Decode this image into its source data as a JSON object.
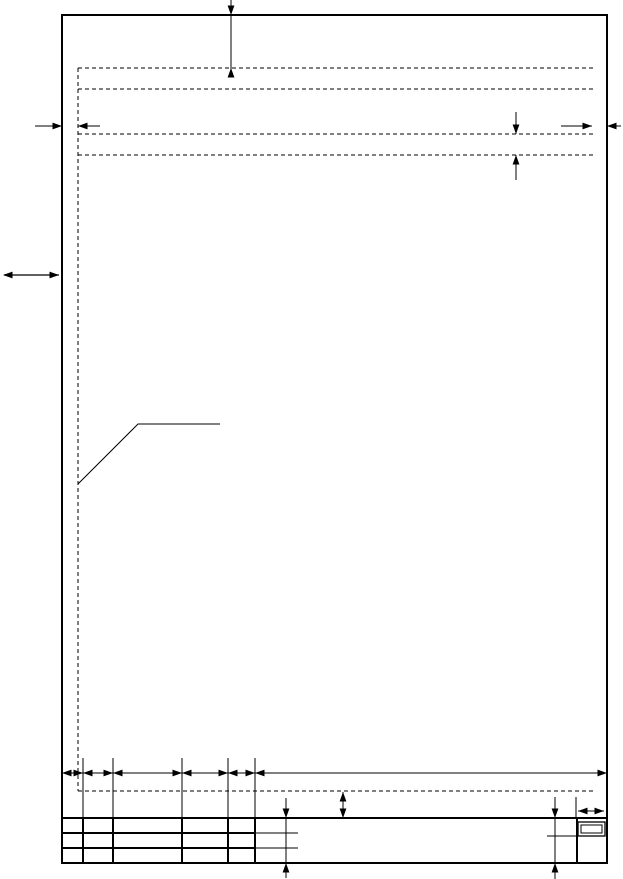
{
  "figure": {
    "description": "drawing-sheet-template-with-margin-and-title-block-dimensions",
    "background": "#ffffff",
    "ink": "#000000"
  },
  "drawing": {
    "width": 623,
    "height": 879,
    "dash_pattern": "4 3",
    "arrow": {
      "length": 9.5,
      "half_width": 3.4
    },
    "groups": [
      {
        "name": "sheet-frame",
        "rects": [
          {
            "name": "sheet-border",
            "x": 62,
            "y": 15,
            "w": 545,
            "h": 848,
            "sw": 2
          }
        ]
      },
      {
        "name": "text-margin-guides",
        "lines": [
          {
            "name": "left-margin-guide",
            "x1": 78,
            "y1": 68,
            "x2": 78,
            "y2": 791,
            "sw": 1,
            "dash": true
          },
          {
            "name": "top-margin-guide",
            "x1": 78,
            "y1": 68,
            "x2": 593,
            "y2": 68,
            "sw": 1,
            "dash": true
          },
          {
            "name": "header-guide-1",
            "x1": 78,
            "y1": 89,
            "x2": 593,
            "y2": 89,
            "sw": 1,
            "dash": true
          },
          {
            "name": "header-guide-2",
            "x1": 78,
            "y1": 134,
            "x2": 593,
            "y2": 134,
            "sw": 1,
            "dash": true
          },
          {
            "name": "header-guide-3",
            "x1": 78,
            "y1": 155,
            "x2": 593,
            "y2": 155,
            "sw": 1,
            "dash": true
          },
          {
            "name": "bottom-margin-guide",
            "x1": 78,
            "y1": 791,
            "x2": 593,
            "y2": 791,
            "sw": 1,
            "dash": true
          }
        ]
      },
      {
        "name": "leader-line",
        "polylines": [
          {
            "name": "margin-callout-leader",
            "sw": 1,
            "points": [
              [
                78,
                484
              ],
              [
                138,
                424
              ],
              [
                220,
                424
              ]
            ]
          }
        ]
      },
      {
        "name": "title-block",
        "lines": [
          {
            "name": "title-block-top",
            "x1": 62,
            "y1": 818,
            "x2": 607,
            "y2": 818,
            "sw": 2
          },
          {
            "name": "title-block-row-1",
            "x1": 62,
            "y1": 833,
            "x2": 255,
            "y2": 833,
            "sw": 2
          },
          {
            "name": "title-block-row-2",
            "x1": 62,
            "y1": 848,
            "x2": 255,
            "y2": 848,
            "sw": 2
          },
          {
            "name": "title-block-col-1",
            "x1": 83,
            "y1": 818,
            "x2": 83,
            "y2": 863,
            "sw": 2
          },
          {
            "name": "title-block-col-2",
            "x1": 113,
            "y1": 818,
            "x2": 113,
            "y2": 863,
            "sw": 2
          },
          {
            "name": "title-block-col-3",
            "x1": 182,
            "y1": 818,
            "x2": 182,
            "y2": 863,
            "sw": 2
          },
          {
            "name": "title-block-col-4",
            "x1": 228,
            "y1": 818,
            "x2": 228,
            "y2": 863,
            "sw": 2
          },
          {
            "name": "title-block-col-5",
            "x1": 255,
            "y1": 818,
            "x2": 255,
            "y2": 863,
            "sw": 2
          },
          {
            "name": "title-block-col-6",
            "x1": 577,
            "y1": 818,
            "x2": 577,
            "y2": 863,
            "sw": 2
          },
          {
            "name": "row-1-stub",
            "x1": 255,
            "y1": 833,
            "x2": 298,
            "y2": 833,
            "sw": 1
          },
          {
            "name": "row-2-stub",
            "x1": 255,
            "y1": 848,
            "x2": 298,
            "y2": 848,
            "sw": 1
          },
          {
            "name": "sheet-cell-divider",
            "x1": 547,
            "y1": 836,
            "x2": 578,
            "y2": 836,
            "sw": 1
          }
        ],
        "rects": [
          {
            "name": "sheet-number-box-outer",
            "x": 578,
            "y": 822,
            "w": 27,
            "h": 14,
            "sw": 1.3
          },
          {
            "name": "sheet-number-box-inner",
            "x": 581,
            "y": 825,
            "w": 21,
            "h": 8,
            "sw": 1
          }
        ]
      },
      {
        "name": "top-margin-dimension",
        "lines": [
          {
            "name": "dim-line",
            "x1": 231,
            "y1": 0,
            "x2": 231,
            "y2": 77,
            "sw": 1
          }
        ],
        "arrows": [
          {
            "name": "arrowhead-down",
            "x": 231,
            "y": 15,
            "dir": "down"
          },
          {
            "name": "arrowhead-up",
            "x": 231,
            "y": 68,
            "dir": "up"
          }
        ]
      },
      {
        "name": "left-margin-dimension",
        "lines": [
          {
            "name": "dim-tail-left",
            "x1": 35,
            "y1": 126,
            "x2": 62,
            "y2": 126,
            "sw": 1
          },
          {
            "name": "dim-tail-right",
            "x1": 78,
            "y1": 126,
            "x2": 100,
            "y2": 126,
            "sw": 1
          }
        ],
        "arrows": [
          {
            "name": "arrowhead-right",
            "x": 62,
            "y": 126,
            "dir": "right"
          },
          {
            "name": "arrowhead-left",
            "x": 78,
            "y": 126,
            "dir": "left"
          }
        ]
      },
      {
        "name": "right-margin-dimension",
        "lines": [
          {
            "name": "dim-tail-left",
            "x1": 561,
            "y1": 126,
            "x2": 592,
            "y2": 126,
            "sw": 1
          },
          {
            "name": "dim-tail-right",
            "x1": 607,
            "y1": 126,
            "x2": 621,
            "y2": 126,
            "sw": 1
          }
        ],
        "arrows": [
          {
            "name": "arrowhead-right",
            "x": 592,
            "y": 126,
            "dir": "right"
          },
          {
            "name": "arrowhead-left",
            "x": 607,
            "y": 126,
            "dir": "left"
          }
        ]
      },
      {
        "name": "header-spacing-dimension",
        "lines": [
          {
            "name": "dim-tail-top",
            "x1": 516,
            "y1": 112,
            "x2": 516,
            "y2": 134,
            "sw": 1
          },
          {
            "name": "dim-tail-bottom",
            "x1": 516,
            "y1": 155,
            "x2": 516,
            "y2": 180,
            "sw": 1
          }
        ],
        "arrows": [
          {
            "name": "arrowhead-down",
            "x": 516,
            "y": 134,
            "dir": "down"
          },
          {
            "name": "arrowhead-up",
            "x": 516,
            "y": 155,
            "dir": "up"
          }
        ]
      },
      {
        "name": "binding-margin-arrow",
        "lines": [
          {
            "name": "dim-line",
            "x1": 4,
            "y1": 275,
            "x2": 59,
            "y2": 275,
            "sw": 1.2
          }
        ],
        "arrows": [
          {
            "name": "arrowhead-left",
            "x": 3,
            "y": 275,
            "dir": "left"
          },
          {
            "name": "arrowhead-right",
            "x": 59,
            "y": 275,
            "dir": "right"
          }
        ]
      },
      {
        "name": "column-extension-lines",
        "lines": [
          {
            "name": "extension-line",
            "x1": 83,
            "y1": 758,
            "x2": 83,
            "y2": 818,
            "sw": 1
          },
          {
            "name": "extension-line",
            "x1": 113,
            "y1": 758,
            "x2": 113,
            "y2": 818,
            "sw": 1
          },
          {
            "name": "extension-line",
            "x1": 182,
            "y1": 758,
            "x2": 182,
            "y2": 818,
            "sw": 1
          },
          {
            "name": "extension-line",
            "x1": 228,
            "y1": 758,
            "x2": 228,
            "y2": 818,
            "sw": 1
          },
          {
            "name": "extension-line",
            "x1": 255,
            "y1": 758,
            "x2": 255,
            "y2": 818,
            "sw": 1
          },
          {
            "name": "extension-line",
            "x1": 576,
            "y1": 797,
            "x2": 576,
            "y2": 818,
            "sw": 1
          }
        ]
      },
      {
        "name": "column-width-dimension-chain",
        "lines": [
          {
            "name": "dim-line",
            "x1": 62,
            "y1": 773,
            "x2": 607,
            "y2": 773,
            "sw": 1
          }
        ],
        "arrows": [
          {
            "name": "arrowhead-left",
            "x": 62,
            "y": 773,
            "dir": "left"
          },
          {
            "name": "arrowhead-right",
            "x": 83,
            "y": 773,
            "dir": "right"
          },
          {
            "name": "arrowhead-left",
            "x": 83,
            "y": 773,
            "dir": "left"
          },
          {
            "name": "arrowhead-right",
            "x": 113,
            "y": 773,
            "dir": "right"
          },
          {
            "name": "arrowhead-left",
            "x": 113,
            "y": 773,
            "dir": "left"
          },
          {
            "name": "arrowhead-right",
            "x": 182,
            "y": 773,
            "dir": "right"
          },
          {
            "name": "arrowhead-left",
            "x": 182,
            "y": 773,
            "dir": "left"
          },
          {
            "name": "arrowhead-right",
            "x": 228,
            "y": 773,
            "dir": "right"
          },
          {
            "name": "arrowhead-left",
            "x": 228,
            "y": 773,
            "dir": "left"
          },
          {
            "name": "arrowhead-right",
            "x": 255,
            "y": 773,
            "dir": "right"
          },
          {
            "name": "arrowhead-left",
            "x": 255,
            "y": 773,
            "dir": "left"
          },
          {
            "name": "arrowhead-right",
            "x": 607,
            "y": 773,
            "dir": "right"
          }
        ]
      },
      {
        "name": "footer-gap-dimension",
        "lines": [
          {
            "name": "dim-line",
            "x1": 343,
            "y1": 792,
            "x2": 343,
            "y2": 818,
            "sw": 1
          }
        ],
        "arrows": [
          {
            "name": "arrowhead-up",
            "x": 343,
            "y": 792,
            "dir": "up"
          },
          {
            "name": "arrowhead-down",
            "x": 343,
            "y": 818,
            "dir": "down"
          }
        ]
      },
      {
        "name": "title-height-dimension-left",
        "lines": [
          {
            "name": "dim-line",
            "x1": 286,
            "y1": 798,
            "x2": 286,
            "y2": 878,
            "sw": 1
          }
        ],
        "arrows": [
          {
            "name": "arrowhead-down",
            "x": 286,
            "y": 818,
            "dir": "down"
          },
          {
            "name": "arrowhead-up",
            "x": 286,
            "y": 863,
            "dir": "up"
          }
        ]
      },
      {
        "name": "title-height-dimension-right",
        "lines": [
          {
            "name": "dim-line",
            "x1": 555,
            "y1": 797,
            "x2": 555,
            "y2": 879,
            "sw": 1
          }
        ],
        "arrows": [
          {
            "name": "arrowhead-down",
            "x": 555,
            "y": 818,
            "dir": "down"
          },
          {
            "name": "arrowhead-up",
            "x": 555,
            "y": 863,
            "dir": "up"
          }
        ]
      },
      {
        "name": "sheet-number-cell-width-dimension",
        "lines": [
          {
            "name": "dim-line",
            "x1": 578,
            "y1": 811,
            "x2": 604,
            "y2": 811,
            "sw": 1
          }
        ],
        "arrows": [
          {
            "name": "arrowhead-left",
            "x": 578,
            "y": 811,
            "dir": "left"
          },
          {
            "name": "arrowhead-right",
            "x": 604,
            "y": 811,
            "dir": "right"
          }
        ]
      }
    ]
  }
}
